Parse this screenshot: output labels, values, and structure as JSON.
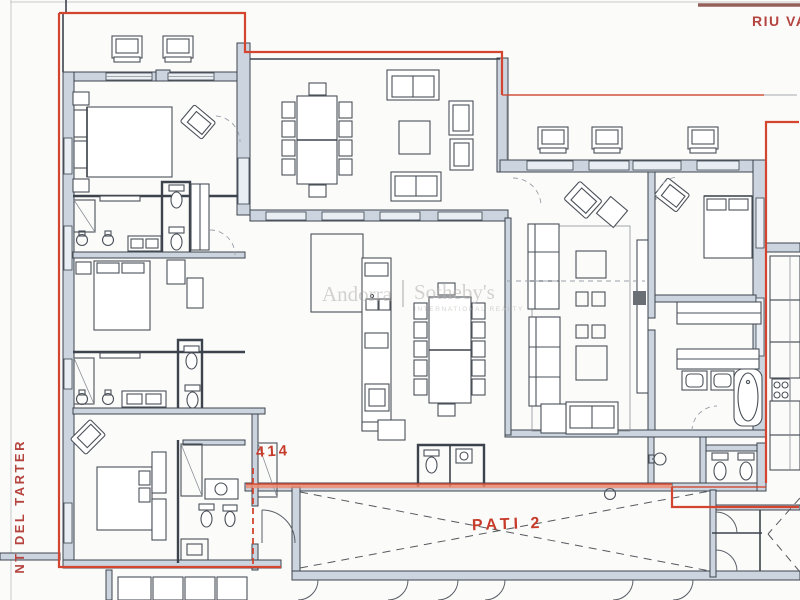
{
  "labels": {
    "street_top_right": "RIU VA",
    "street_left": "NT DEL TARTER",
    "patio_label": "PATI 2",
    "handwritten_note": "414"
  },
  "watermark": {
    "brand_left": "Andorra",
    "brand_right": "Sotheby's",
    "tagline": "INTERNATIONAL REALTY"
  },
  "colors": {
    "paper": "#fbfbfa",
    "boundary_red": "#d4452f",
    "patio_highlight": "#ee8a6e",
    "street_label_red": "#b5443f",
    "handwriting_red": "#c63b2a",
    "wall_stroke": "#3d434c",
    "wall_fill": "#ccd4e0",
    "window_fill": "#e9eef5",
    "furniture_stroke": "#4a5058",
    "watermark_gray": "#b3b0ac",
    "page_line_gray": "#c9c9c9"
  }
}
